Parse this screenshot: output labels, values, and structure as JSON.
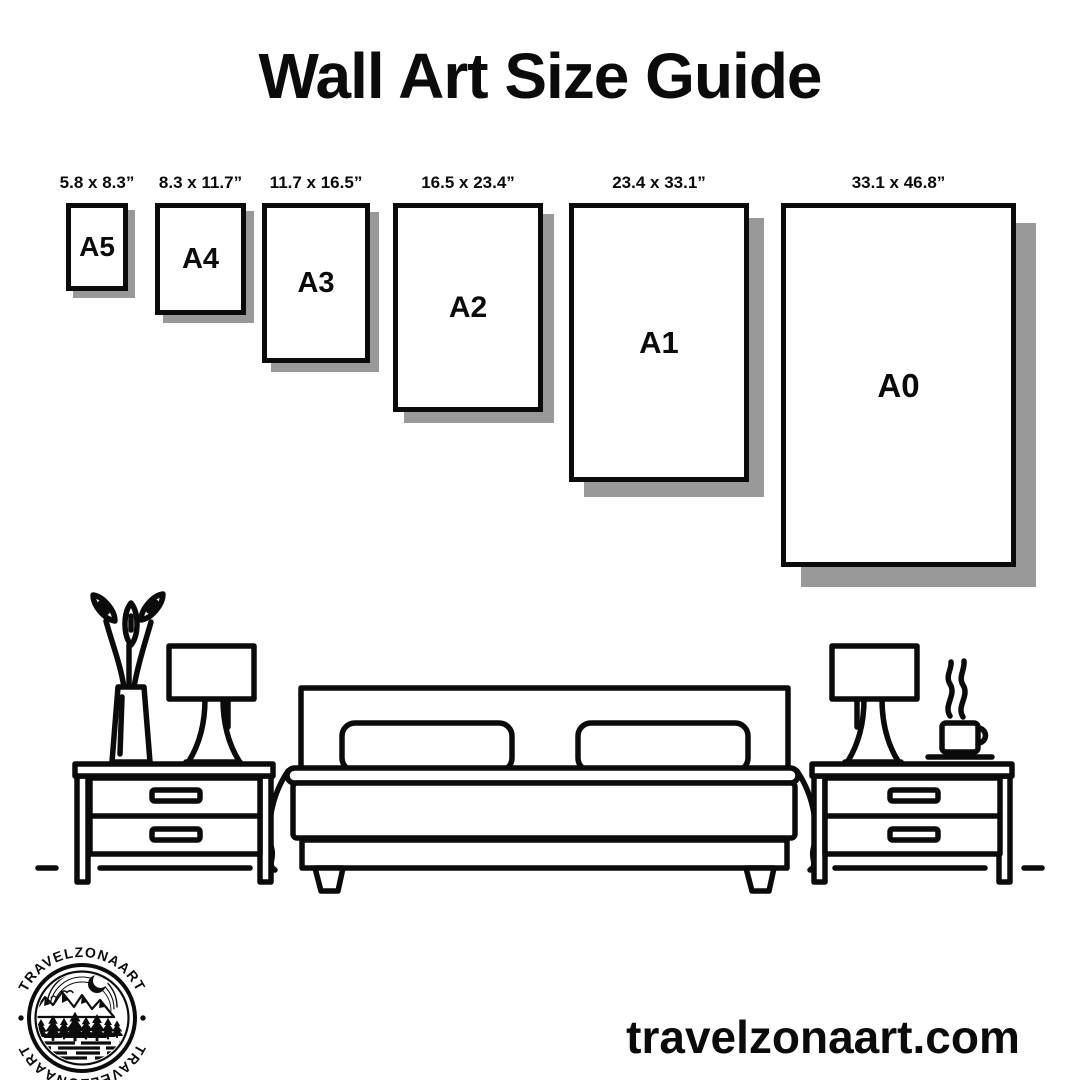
{
  "title": "Wall Art Size Guide",
  "sizes": [
    {
      "code": "A5",
      "dimensions": "5.8 x 8.3”",
      "box": {
        "left": 66,
        "top": 203,
        "width": 62,
        "height": 88,
        "shadow": 7
      }
    },
    {
      "code": "A4",
      "dimensions": "8.3 x 11.7”",
      "box": {
        "left": 155,
        "top": 203,
        "width": 91,
        "height": 112,
        "shadow": 8
      }
    },
    {
      "code": "A3",
      "dimensions": "11.7 x 16.5”",
      "box": {
        "left": 262,
        "top": 203,
        "width": 108,
        "height": 160,
        "shadow": 9
      }
    },
    {
      "code": "A2",
      "dimensions": "16.5 x 23.4”",
      "box": {
        "left": 393,
        "top": 203,
        "width": 150,
        "height": 209,
        "shadow": 11
      }
    },
    {
      "code": "A1",
      "dimensions": "23.4 x 33.1”",
      "box": {
        "left": 569,
        "top": 203,
        "width": 180,
        "height": 279,
        "shadow": 15
      }
    },
    {
      "code": "A0",
      "dimensions": "33.1 x 46.8”",
      "box": {
        "left": 781,
        "top": 203,
        "width": 235,
        "height": 364,
        "shadow": 20
      }
    }
  ],
  "logo": {
    "badge_text_top": "TRAVELZONAART",
    "badge_text_bottom": "TRAVELZONAART",
    "separator": "•"
  },
  "footer": {
    "website": "travelzonaart.com"
  },
  "colors": {
    "ink": "#0b0b0b",
    "shadow": "#999999",
    "background": "#ffffff"
  }
}
